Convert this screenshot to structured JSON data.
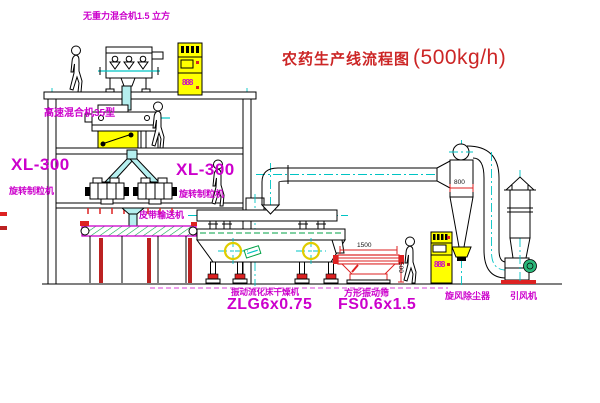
{
  "title": {
    "text": "农药生产线流程图",
    "capacity": "(500kg/h)"
  },
  "labels": {
    "top_mixer": "无重力混合机1.5 立方",
    "mid_mixer": "高速混合机35型",
    "xl300_left": "XL-300",
    "granulator_left": "旋转制粒机",
    "xl300_right": "XL-300",
    "granulator_right": "旋转制粒机",
    "belt_conveyor": "皮带输送机",
    "dryer_name": "振动流化床干燥机",
    "dryer_model": "ZLG6x0.75",
    "screen_name": "方形振动筛",
    "screen_model": "FS0.6x1.5",
    "cyclone_name": "旋风除尘器",
    "fan_name": "引风机"
  },
  "dimensions": {
    "screen_length": "1500",
    "screen_height": "500",
    "cyclone_diameter": "800"
  },
  "displays": {
    "cabinet1": "888",
    "cabinet2": "888"
  },
  "colors": {
    "label_magenta": "#cc00cc",
    "title_red": "#cc2626",
    "centerline_cyan": "#00c4c4",
    "cabinet_yellow": "#ffff00",
    "accent_green": "#00a046",
    "equipment_red": "#dd2222"
  }
}
